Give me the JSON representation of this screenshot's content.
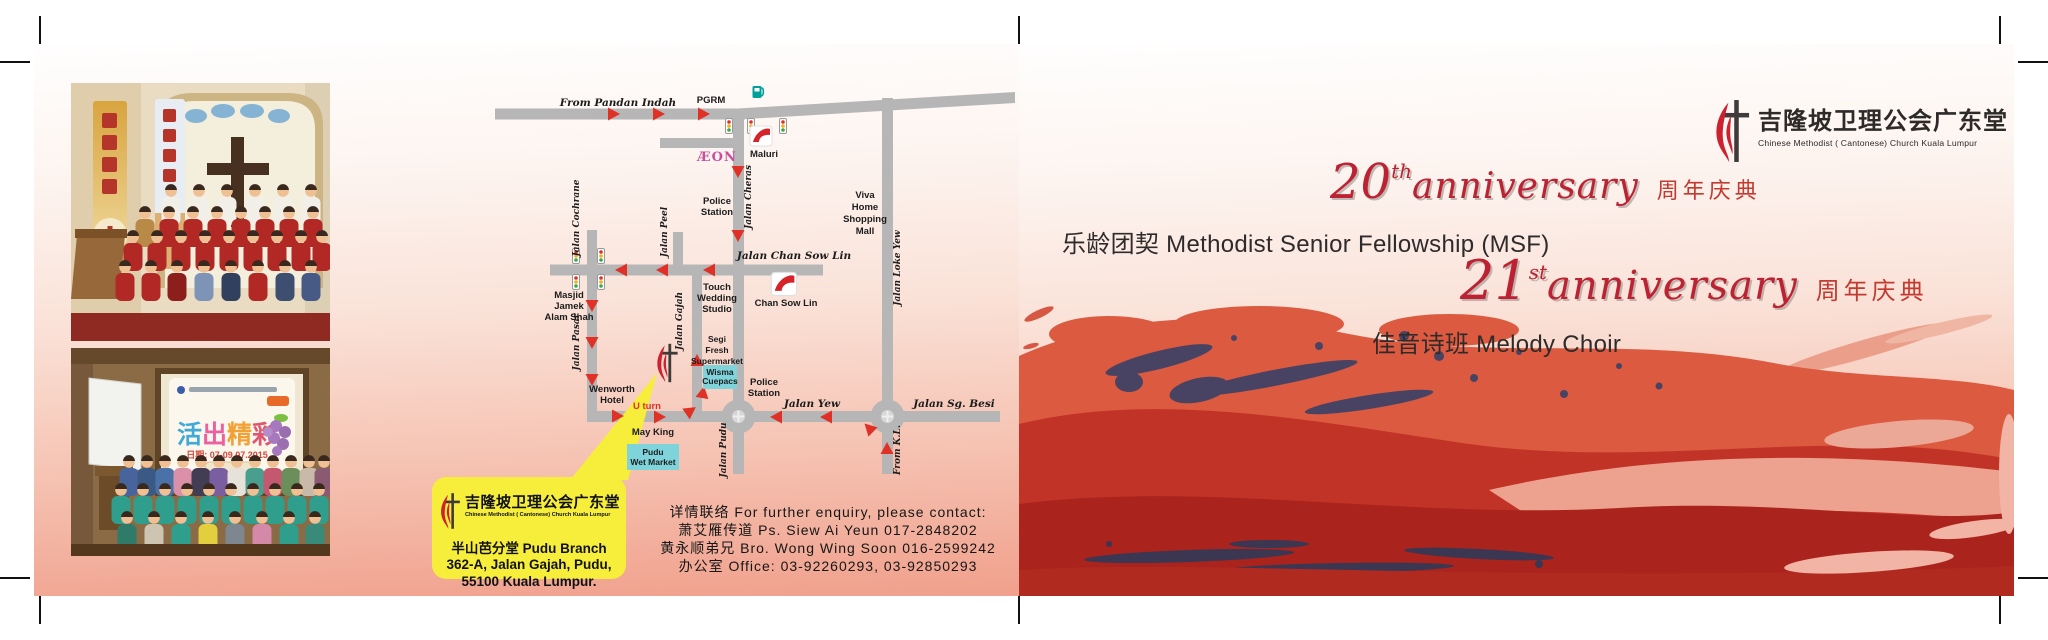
{
  "brand": {
    "zh": "吉隆坡卫理公会广东堂",
    "en": "Chinese Methodist ( Cantonese) Church Kuala Lumpur"
  },
  "anniversary20": {
    "number": "20",
    "suffix": "th",
    "word": "anniversary",
    "zh": "周年庆典",
    "line": "乐龄团契 Methodist Senior Fellowship (MSF)"
  },
  "anniversary21": {
    "number": "21",
    "suffix": "st",
    "word": "anniversary",
    "zh": "周年庆典",
    "line": "佳音诗班 Melody Choir"
  },
  "info_box": {
    "zh_name": "吉隆坡卫理公会广东堂",
    "en_name": "Chinese Methodist ( Cantonese) Church Kuala Lumpur",
    "addr1": "半山芭分堂 Pudu Branch",
    "addr2": "362-A, Jalan Gajah, Pudu,",
    "addr3": "55100 Kuala Lumpur."
  },
  "contact": {
    "line1": "详情联络 For further enquiry, please contact:",
    "line2": "萧艾雁传道 Ps. Siew Ai Yeun 017-2848202",
    "line3": "黄永顺弟兄 Bro. Wong Wing Soon 016-2599242",
    "line4": "办公室 Office: 03-92260293, 03-92850293"
  },
  "map": {
    "from_pandan_indah": "From Pandan Indah",
    "pgrm": "PGRM",
    "aeon": "ÆON",
    "maluri": "Maluri",
    "jalan_cheras": "Jalan Cheras",
    "police1_l1": "Police",
    "police1_l2": "Station",
    "viva_l1": "Viva",
    "viva_l2": "Home",
    "viva_l3": "Shopping",
    "viva_l4": "Mall",
    "jalan_chan_sow_lin": "Jalan Chan Sow Lin",
    "chan_sow_lin": "Chan Sow Lin",
    "jalan_loke_yew": "Jalan Loke Yew",
    "jalan_cochrane": "Jalan Cochrane",
    "jalan_peel": "Jalan Peel",
    "masjid_l1": "Masjid",
    "masjid_l2": "Jamek",
    "masjid_l3": "Alam Shah",
    "jalan_pasar": "Jalan Pasar",
    "touch_l1": "Touch",
    "touch_l2": "Wedding",
    "touch_l3": "Studio",
    "jalan_gajah": "Jalan Gajah",
    "segi_l1": "Segi",
    "segi_l2": "Fresh",
    "segi_l3": "Supermarket",
    "wisma_l1": "Wisma",
    "wisma_l2": "Cuepacs",
    "police2_l1": "Police",
    "police2_l2": "Station",
    "wenworth_l1": "Wenworth",
    "wenworth_l2": "Hotel",
    "u_turn": "U turn",
    "may_king": "May King",
    "pudu_l1": "Pudu",
    "pudu_l2": "Wet Market",
    "jalan_yew": "Jalan Yew",
    "jalan_sg_besi": "Jalan Sg. Besi",
    "jalan_pudu": "Jalan Pudu",
    "from_kl": "From K.L."
  },
  "photos": {
    "banner_chars": [
      "活",
      "出",
      "精",
      "彩"
    ],
    "banner_date": "日期: 07-09.07.2015"
  },
  "colors": {
    "script_red": "#bc2231",
    "zh_red": "#c23a30",
    "brand_red": "#cd2130",
    "arrow_red": "#e03127",
    "road_gray": "#b7b6b6",
    "callout_yellow": "#f6ee3b",
    "cyan_box": "#7fd4db",
    "aeon_pink": "#c94f9e"
  }
}
